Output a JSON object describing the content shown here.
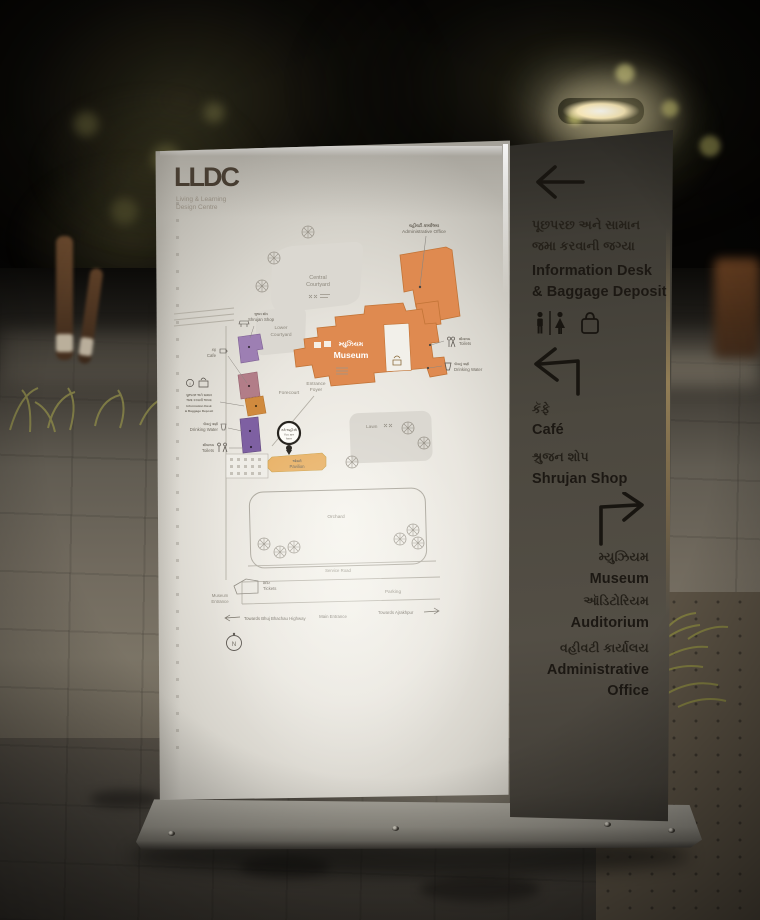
{
  "logo": {
    "name": "LLDC",
    "tagline1": "Living & Learning",
    "tagline2": "Design Centre"
  },
  "map": {
    "admin_gu": "વહીવટી કાર્યાલય",
    "admin_en": "Administrative Office",
    "central1": "Central",
    "central2": "Courtyard",
    "lower1": "Lower",
    "lower2": "Courtyard",
    "shop_gu": "શ્રુજન શોપ",
    "shop_en": "Shrujan Shop",
    "cafe_gu": "કૅફે",
    "cafe_en": "Cafe",
    "info_gu1": "પૂછપરછ અને સામાન",
    "info_gu2": "જમા કરવાની જગ્યા",
    "info_en1": "Information Desk",
    "info_en2": "& Baggage Deposit",
    "water_gu": "પીવાનું પાણી",
    "water_en": "Drinking Water",
    "toilets_gu": "શૌચાલય",
    "toilets_en": "Toilets",
    "museum_gu": "મ્યુઝિયમ",
    "museum_en": "Museum",
    "foyer1": "Entrance",
    "foyer2": "Foyer",
    "forecourt": "Forecourt",
    "lawn": "Lawn",
    "pavilion_gu": "ઓસરી",
    "pavilion_en": "Pavilion",
    "orchard": "Orchard",
    "service_road": "Service Road",
    "tickets_gu": "ટિકિટ",
    "tickets_en": "Tickets",
    "mus_ent1": "Museum",
    "mus_ent2": "Entrance",
    "parking": "Parking",
    "towards_highway": "Towards Bhuj Bhachau Highway",
    "main_entrance": "Main Entrance",
    "towards_ajrakhpur": "Towards Ajrakhpur",
    "yah_gu": "તમે અહીં છો",
    "yah_en1": "You are",
    "yah_en2": "here",
    "compass": "N"
  },
  "directory": {
    "info_gu1": "પૂછપરછ અને સામાન",
    "info_gu2": "જમા કરવાની જગ્યા",
    "info_en1": "Information Desk",
    "info_en2": "& Baggage Deposit",
    "cafe_gu": "કૅફે",
    "cafe_en": "Café",
    "shop_gu": "શ્રુજન શોપ",
    "shop_en": "Shrujan Shop",
    "museum_gu": "મ્યુઝિયમ",
    "museum_en": "Museum",
    "auditorium_gu": "ઑડિટોરિયમ",
    "auditorium_en": "Auditorium",
    "admin_gu": "વહીવટી કાર્યાલય",
    "admin_en1": "Administrative",
    "admin_en2": "Office"
  },
  "colors": {
    "museum_orange": "#df8a50",
    "shop_purple": "#9d7fb3",
    "toilet_purple": "#7e60a2",
    "cafe_mauve": "#b27d88",
    "info_tan": "#d08a3e",
    "pavilion_amber": "#e9b369",
    "panel_dark": "#4e4a42",
    "panel_light": "#e9e6df"
  }
}
